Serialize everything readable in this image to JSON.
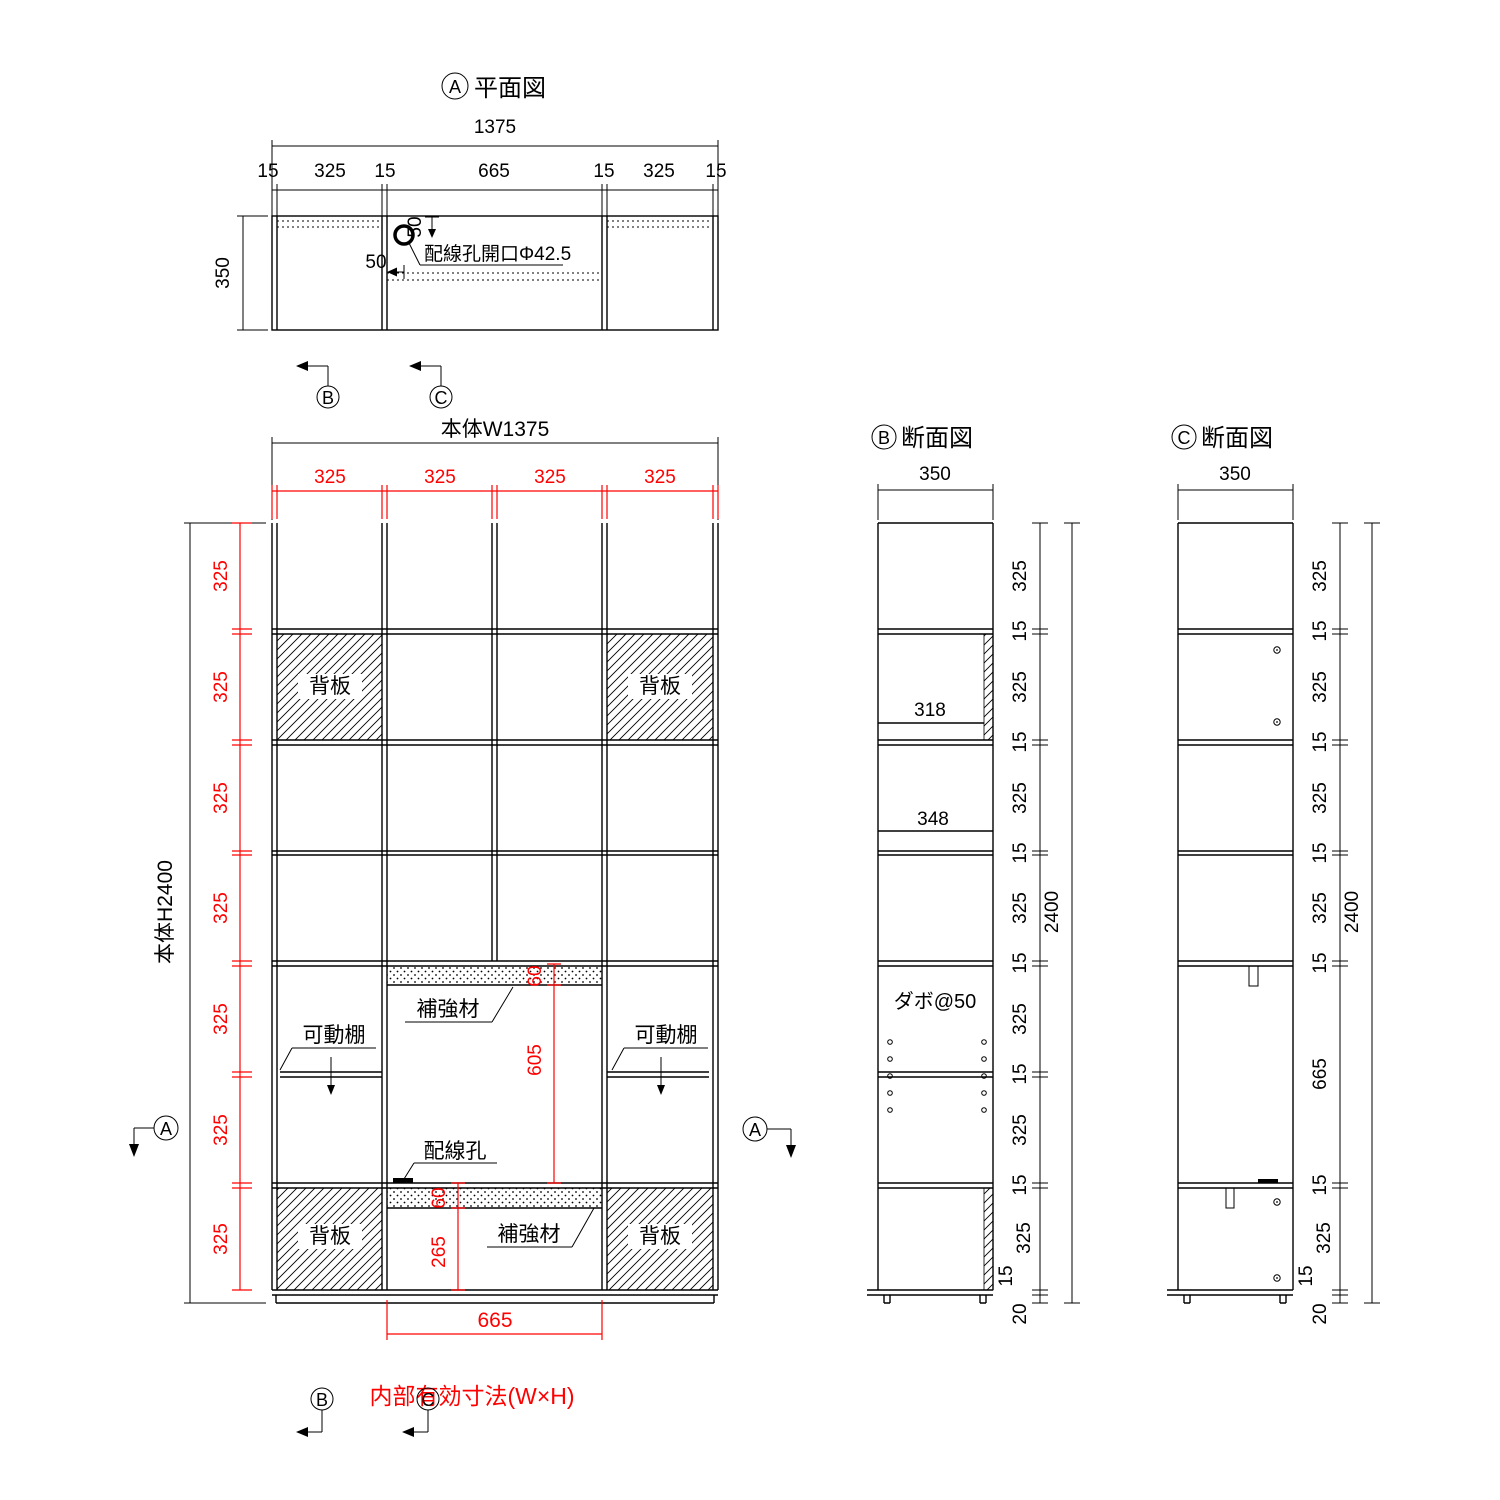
{
  "colors": {
    "line": "#000000",
    "dim_accent": "#ff0000",
    "background": "#ffffff"
  },
  "plan": {
    "marker": "A",
    "title": "平面図",
    "overall_width": "1375",
    "width_chain": [
      "15",
      "325",
      "15",
      "665",
      "15",
      "325",
      "15"
    ],
    "depth": "350",
    "hole_label": "配線孔開口Φ42.5",
    "hole_offset_top": "50",
    "hole_offset_side": "50",
    "cut_marker_b": "B",
    "cut_marker_c": "C"
  },
  "elevation": {
    "overall_width_label": "本体W1375",
    "overall_height_label": "本体H2400",
    "column_dims": [
      "325",
      "325",
      "325",
      "325"
    ],
    "row_dims": [
      "325",
      "325",
      "325",
      "325",
      "325",
      "325",
      "325"
    ],
    "back_panel_label": "背板",
    "reinforcement_label": "補強材",
    "movable_shelf_label": "可動棚",
    "wiring_hole_label": "配線孔",
    "opening_top_depth": "60",
    "opening_height": "605",
    "bottom_reinforcement_depth": "60",
    "bottom_opening_height": "265",
    "opening_width": "665",
    "inner_dim_note": "内部有効寸法(W×H)",
    "section_marker_a": "A",
    "cut_marker_b": "B",
    "cut_marker_c": "C"
  },
  "section_b": {
    "marker": "B",
    "title": "断面図",
    "depth": "350",
    "clear_depth_back": "318",
    "clear_depth_open": "348",
    "dowel_label": "ダボ@50",
    "height_chain": [
      "325",
      "15",
      "325",
      "15",
      "325",
      "15",
      "325",
      "15",
      "325",
      "15",
      "325",
      "15",
      "325",
      "15",
      "20"
    ],
    "total_height": "2400"
  },
  "section_c": {
    "marker": "C",
    "title": "断面図",
    "depth": "350",
    "height_chain": [
      "325",
      "15",
      "325",
      "15",
      "325",
      "15",
      "325",
      "15",
      "665",
      "15",
      "325",
      "15",
      "20"
    ],
    "total_height": "2400"
  }
}
